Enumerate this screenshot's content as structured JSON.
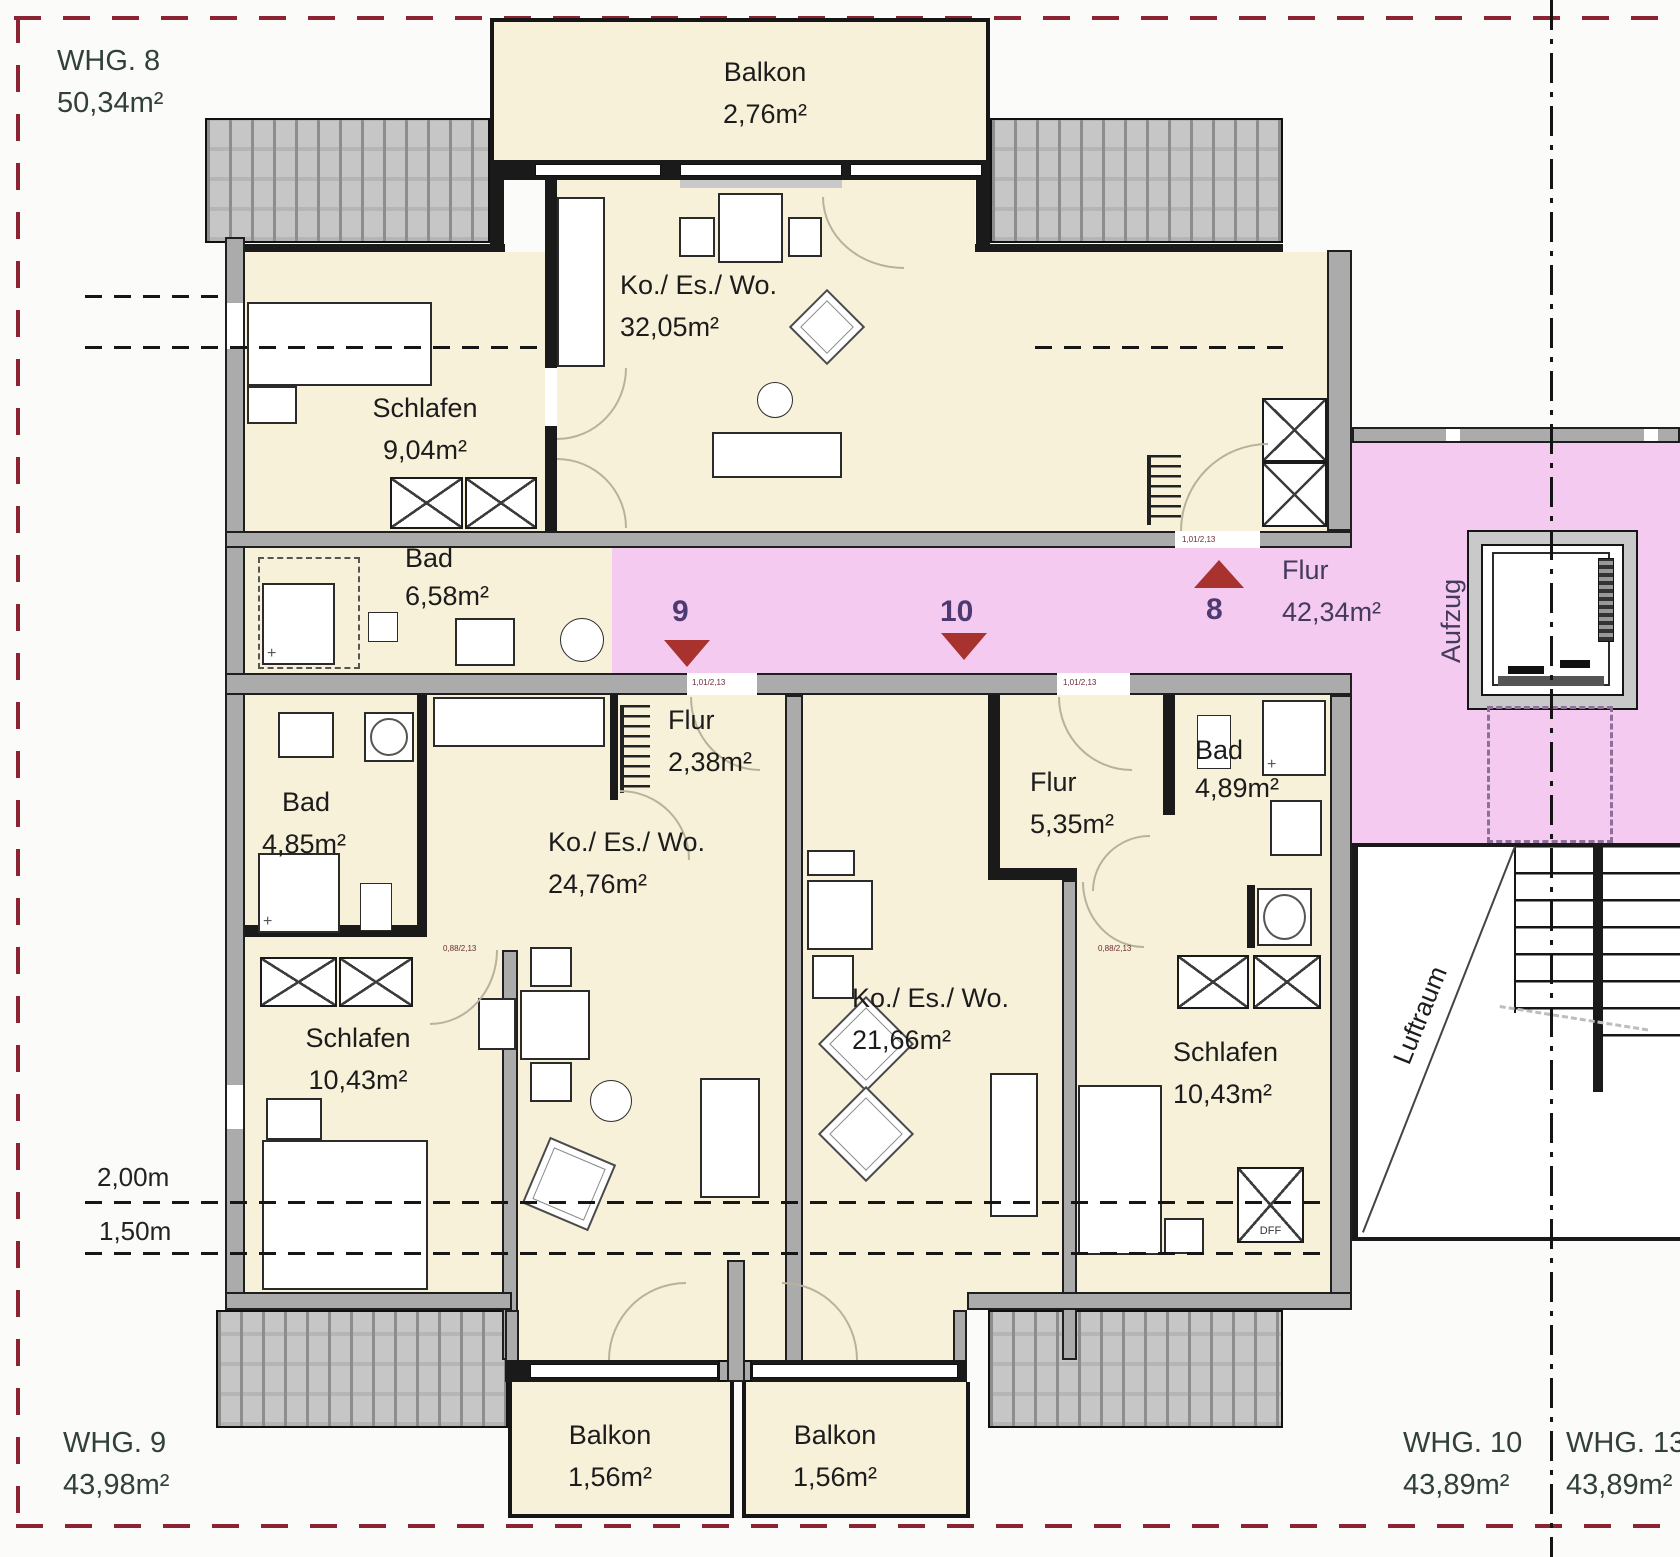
{
  "apartments": {
    "whg8": {
      "name": "WHG. 8",
      "area": "50,34m²"
    },
    "whg9": {
      "name": "WHG. 9",
      "area": "43,98m²"
    },
    "whg10": {
      "name": "WHG. 10",
      "area": "43,89m²"
    },
    "whg13": {
      "name": "WHG. 13",
      "area": "43,89m²"
    }
  },
  "rooms": {
    "balkon_whg8": {
      "name": "Balkon",
      "area": "2,76m²"
    },
    "ko_es_wo_whg8": {
      "name": "Ko./ Es./ Wo.",
      "area": "32,05m²"
    },
    "schlafen_whg8": {
      "name": "Schlafen",
      "area": "9,04m²"
    },
    "bad_whg8": {
      "name": "Bad",
      "area": "6,58m²"
    },
    "flur_zentral": {
      "name": "Flur",
      "area": "42,34m²"
    },
    "flur_whg9": {
      "name": "Flur",
      "area": "2,38m²"
    },
    "bad_whg9": {
      "name": "Bad",
      "area": "4,85m²"
    },
    "ko_es_wo_whg9": {
      "name": "Ko./ Es./ Wo.",
      "area": "24,76m²"
    },
    "schlafen_whg9": {
      "name": "Schlafen",
      "area": "10,43m²"
    },
    "flur_whg10": {
      "name": "Flur",
      "area": "5,35m²"
    },
    "bad_whg10": {
      "name": "Bad",
      "area": "4,89m²"
    },
    "ko_es_wo_whg10": {
      "name": "Ko./ Es./ Wo.",
      "area": "21,66m²"
    },
    "schlafen_whg10": {
      "name": "Schlafen",
      "area": "10,43m²"
    },
    "balkon_whg9": {
      "name": "Balkon",
      "area": "1,56m²"
    },
    "balkon_whg10": {
      "name": "Balkon",
      "area": "1,56m²"
    }
  },
  "core": {
    "elevator_label": "Aufzug",
    "void_label": "Luftraum",
    "roof_window_label": "DFF"
  },
  "unit_markers": {
    "whg8": "8",
    "whg9": "9",
    "whg10": "10"
  },
  "dimensions": {
    "line1": "2,00m",
    "line2": "1,50m"
  },
  "door_labels": {
    "d8": "1,01/2,13",
    "d9": "1,01/2,13",
    "d10": "1,01/2,13",
    "s9": "0,88/2,13",
    "s10": "0,88/2,13"
  },
  "colors": {
    "corridor": "#f4caf0",
    "room_fill": "#f8f1d9",
    "wall": "#ababab",
    "boundary_dashed": "#8b2332",
    "arrow": "#a8322e",
    "room_text": "#1c1c1c",
    "whg_text": "#31403a",
    "corridor_text": "#4d3a70"
  }
}
